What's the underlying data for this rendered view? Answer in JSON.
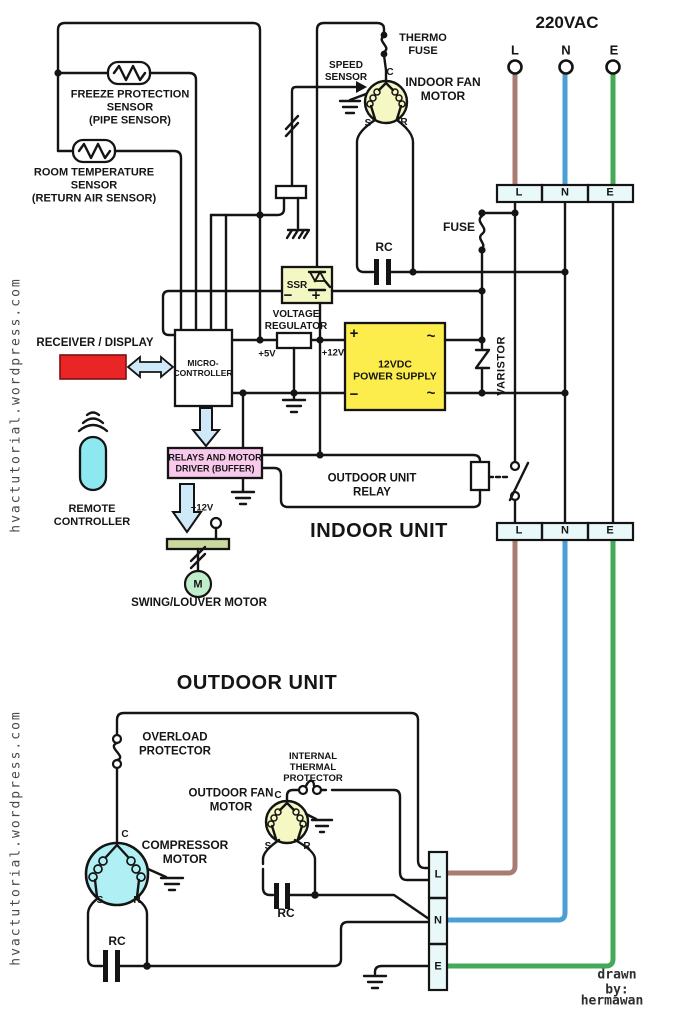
{
  "mains": {
    "title": "220VAC",
    "l": "L",
    "n": "N",
    "e": "E"
  },
  "term": {
    "c": "C",
    "s": "S",
    "r": "R",
    "m": "M",
    "plus": "+",
    "minus": "−",
    "tilde": "~",
    "v5": "+5V",
    "v12": "+12V"
  },
  "indoor": {
    "title": "INDOOR UNIT",
    "thermo_fuse": "THERMO\nFUSE",
    "speed_sensor": "SPEED\nSENSOR",
    "fan_motor": "INDOOR FAN\nMOTOR",
    "freeze_sensor": "FREEZE PROTECTION\nSENSOR\n(PIPE SENSOR)",
    "room_sensor": "ROOM TEMPERATURE\nSENSOR\n(RETURN AIR SENSOR)",
    "receiver": "RECEIVER / DISPLAY",
    "mcu": "MICRO-\nCONTROLLER",
    "ssr": "SSR",
    "vreg": "VOLTAGE\nREGULATOR",
    "psu": "12VDC\nPOWER SUPPLY",
    "rc": "RC",
    "fuse": "FUSE",
    "varistor": "VARISTOR",
    "relay_driver": "RELAYS AND MOTOR\nDRIVER (BUFFER)",
    "outdoor_relay": "OUTDOOR UNIT\nRELAY",
    "remote": "REMOTE\nCONTROLLER",
    "swing_motor": "SWING/LOUVER MOTOR"
  },
  "outdoor": {
    "title": "OUTDOOR UNIT",
    "overload": "OVERLOAD\nPROTECTOR",
    "thermal": "INTERNAL\nTHERMAL\nPROTECTOR",
    "fan_motor": "OUTDOOR FAN\nMOTOR",
    "compressor": "COMPRESSOR\nMOTOR",
    "rc": "RC"
  },
  "credits": {
    "watermark": "hvactutorial.wordpress.com",
    "drawn_by": "drawn by:",
    "author": "hermawan"
  },
  "colors": {
    "line_brown": "#a87c72",
    "neutral_blue": "#4a9fd4",
    "earth_green": "#44aa58",
    "psu_yellow": "#fced4d",
    "ssr_yellow": "#f3f7c3",
    "motor_yellow": "#f6f8c4",
    "compressor_cyan": "#b0f0f4",
    "driver_pink": "#f9c9ec",
    "receiver_red": "#e92525",
    "remote_cyan": "#8ee8f0",
    "arrow_blue": "#cfe9f8",
    "swing_bar_olive": "#ccd99e",
    "swing_motor_green": "#c0eecd"
  }
}
